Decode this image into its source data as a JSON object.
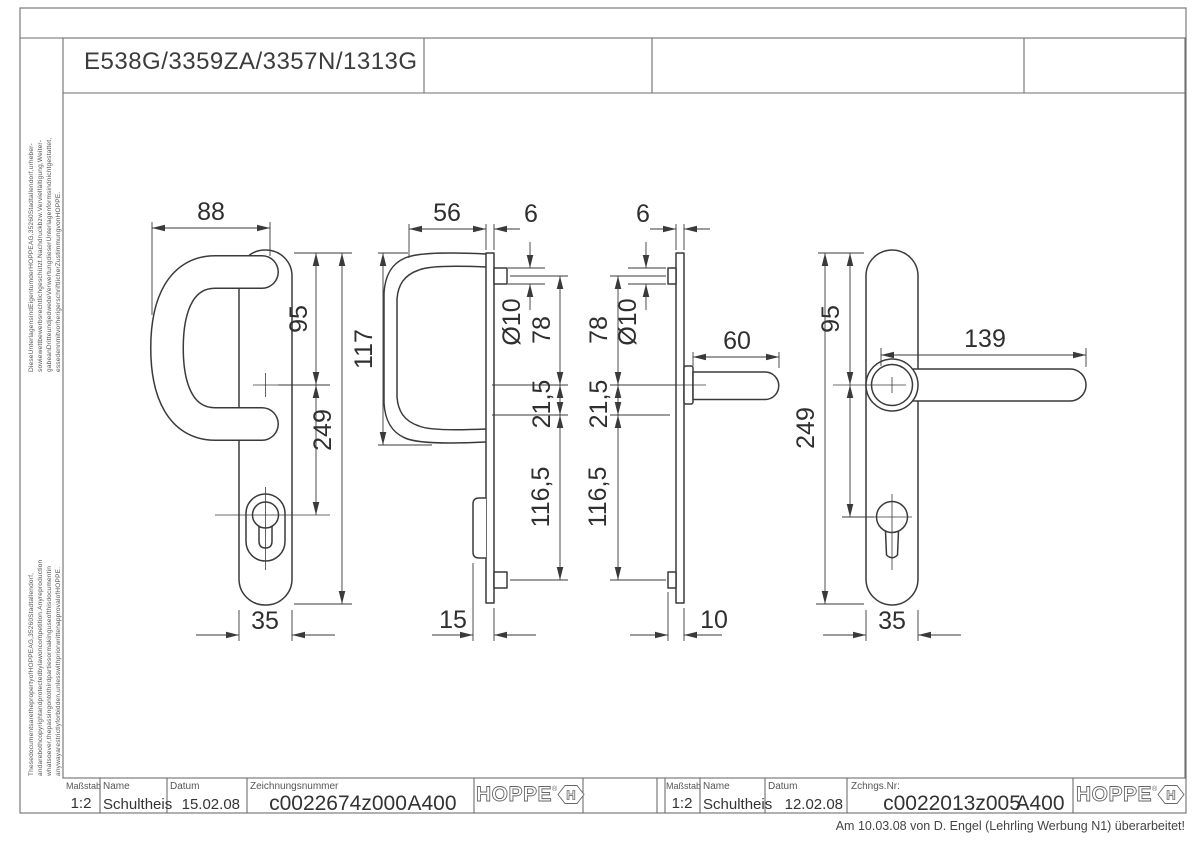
{
  "sheet": {
    "title": "E538G/3359ZA/3357N/1313G",
    "revision_note": "Am 10.03.08 von D. Engel (Lehrling Werbung N1) überarbeitet!",
    "copyright_de": {
      "line1": "DieseUnterlagensindEigentumderHOPPEAG,35260Stadtallendorf,urheber-",
      "line2": "sowiewettbewerbsrechtlichgeschützt.Nachdruckbzw.Vervielfältigung,Weiter-",
      "line3": "gabeanDritteundjedwedeVerwertungdieserUnterlagenformsindnichtgestattet,",
      "line4": "essedennmitvorherigerschriftlicherZustimmungvonHOPPE."
    },
    "copyright_en": {
      "line1": "ThesedocumentsarethepropertyofHOPPEAG,35260Stadtallendorf,",
      "line2": "andarebothcopyrightandprotectedbylawoncompetition.Anyreproduction",
      "line3": "whatsoever,thepassingontothirdpartiesormakinguseofthisdocumentin",
      "line4": "anywayarestrictlyforbidden,unlesswithpriorwrittenapprovalofHOPPE."
    }
  },
  "brand": {
    "name": "HOPPE",
    "registered": "®",
    "hex_letter": "H"
  },
  "title_blocks": {
    "left": {
      "scale_label": "Maßstab",
      "scale": "1:2",
      "name_label": "Name",
      "name": "Schultheis",
      "date_label": "Datum",
      "date": "15.02.08",
      "number_label": "Zeichnungsnummer",
      "number": "c0022674z000",
      "revision": "A400"
    },
    "right": {
      "scale_label": "Maßstab",
      "scale": "1:2",
      "name_label": "Name",
      "name": "Schultheis",
      "date_label": "Datum",
      "date": "12.02.08",
      "number_label": "Zchngs.Nr:",
      "number": "c0022013z005",
      "revision": "A400"
    }
  },
  "views": {
    "pull_front": {
      "dims": {
        "width_top": "88",
        "axis_from_top": "95",
        "total_height": "249",
        "plate_width": "35"
      }
    },
    "pull_side": {
      "dims": {
        "depth": "56",
        "plate_thickness": "6",
        "handle_height": "117",
        "bolt_dia": "Ø10",
        "bolt_to_axis": "78",
        "axis_offset": "21,5",
        "lower_span": "116,5",
        "total_depth": "15"
      }
    },
    "lever_side": {
      "dims": {
        "plate_thickness": "6",
        "bolt_dia": "Ø10",
        "bolt_to_axis": "78",
        "axis_offset": "21,5",
        "lower_span": "116,5",
        "spindle_length": "60",
        "total_depth": "10"
      }
    },
    "lever_front": {
      "dims": {
        "axis_from_top": "95",
        "total_height": "249",
        "handle_length": "139",
        "plate_width": "35"
      }
    }
  }
}
